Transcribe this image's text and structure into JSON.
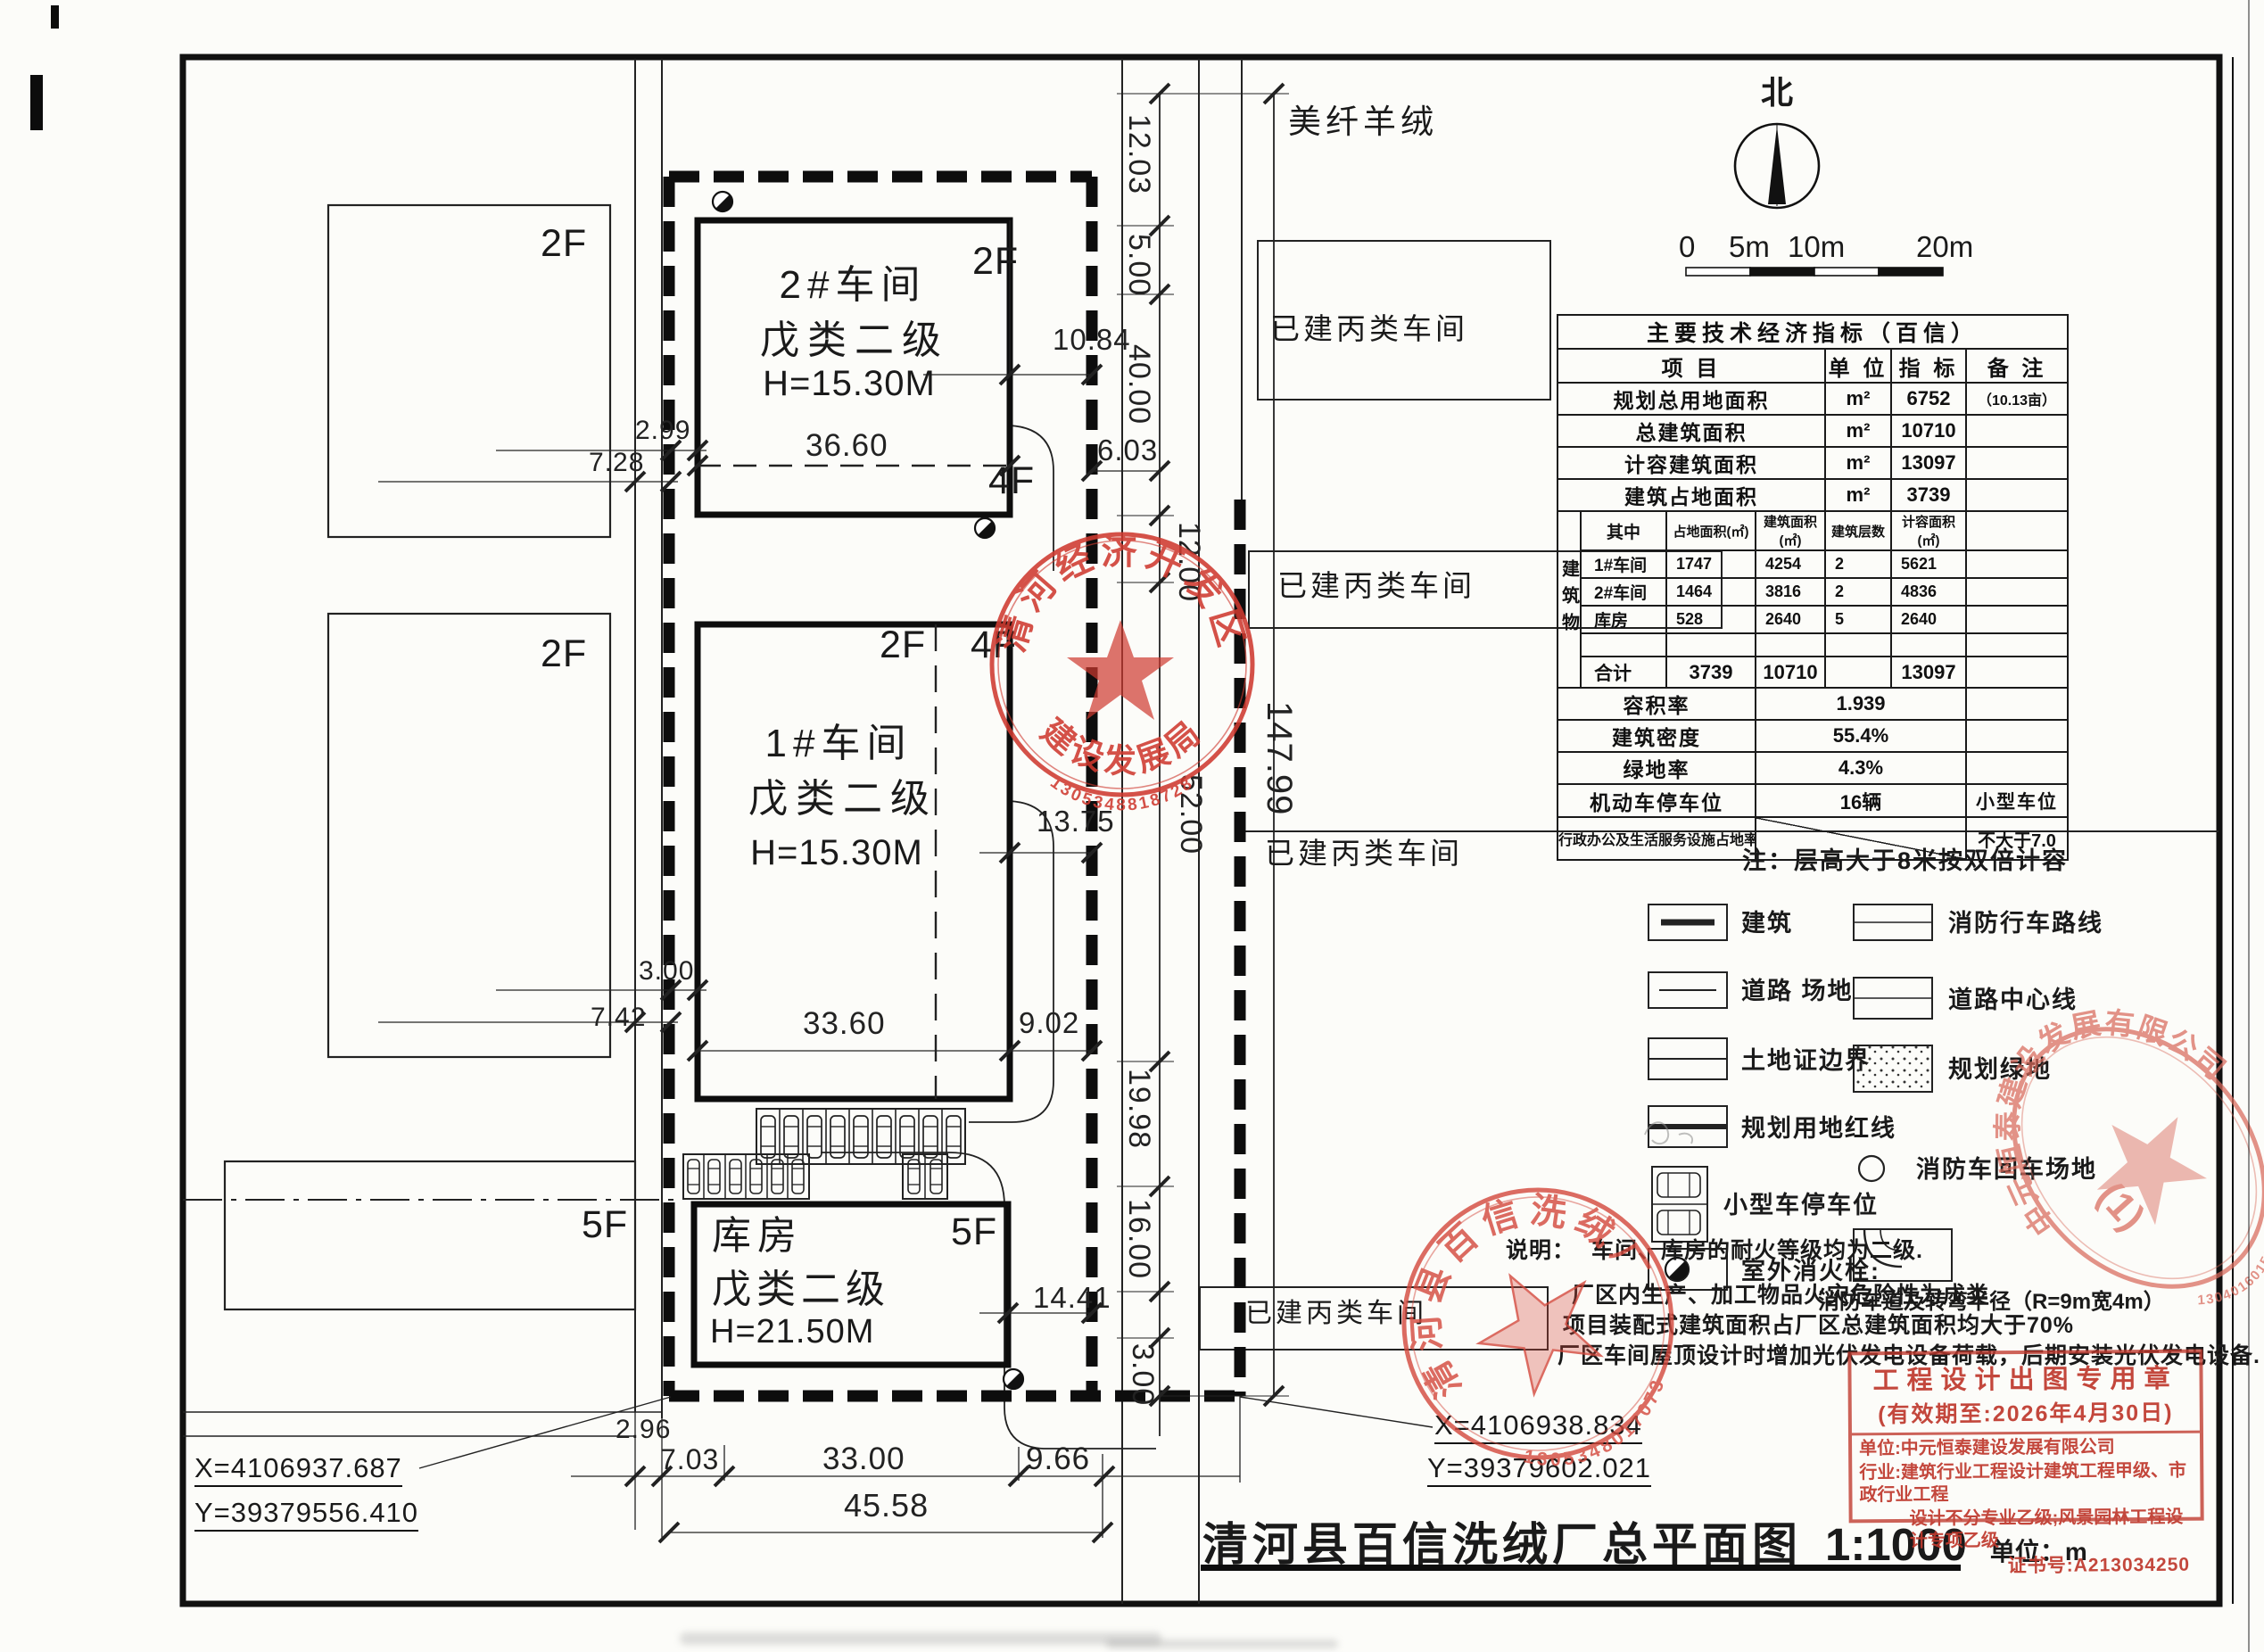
{
  "page": {
    "title": "清河县百信洗绒厂总平面图",
    "scale": "1:1000",
    "unit": "单位：m",
    "north": "北"
  },
  "scalebar": {
    "z": "0",
    "five": "5m",
    "ten": "10m",
    "twenty": "20m"
  },
  "plan": {
    "neighbor": "美纤羊绒",
    "existing": "已建丙类车间",
    "f2": "2F",
    "f4": "4F",
    "f5": "5F",
    "b2": {
      "name": "2#车间",
      "cls": "戊类二级",
      "h": "H=15.30M"
    },
    "b1": {
      "name": "1#车间",
      "cls": "戊类二级",
      "h": "H=15.30M"
    },
    "kf": {
      "name": "库房",
      "cls": "戊类二级",
      "h": "H=21.50M"
    },
    "coords": {
      "x1": "X=4106937.687",
      "y1": "Y=39379556.410",
      "x2": "X=4106938.834",
      "y2": "Y=39379602.021"
    },
    "dims": {
      "t1": "12.03",
      "t2": "5.00",
      "t3": "40.00",
      "t4": "12.00",
      "t5": "52.00",
      "t6": "19.98",
      "t7": "16.00",
      "t8": "3.00",
      "total": "147.99",
      "g1": "10.84",
      "g2": "6.03",
      "w2": "36.60",
      "o1": "2.99",
      "o2": "7.28",
      "w1": "33.60",
      "g3": "9.02",
      "g4": "13.75",
      "o3": "3.00",
      "o4": "7.42",
      "g5": "14.41",
      "b1": "2.96",
      "b2": "7.03",
      "b3": "33.00",
      "b4": "9.66",
      "b5": "45.58"
    }
  },
  "table": {
    "title": "主要技术经济指标（百信）",
    "h_item": "项 目",
    "h_unit": "单 位",
    "h_index": "指 标",
    "h_note": "备 注",
    "rows": [
      {
        "item": "规划总用地面积",
        "unit": "m²",
        "value": "6752",
        "note": "（10.13亩）"
      },
      {
        "item": "总建筑面积",
        "unit": "m²",
        "value": "10710",
        "note": ""
      },
      {
        "item": "计容建筑面积",
        "unit": "m²",
        "value": "13097",
        "note": ""
      },
      {
        "item": "建筑占地面积",
        "unit": "m²",
        "value": "3739",
        "note": ""
      }
    ],
    "group_label": "建筑物",
    "sub_headers": {
      "among": "其中",
      "footprint": "占地面积(㎡)",
      "area": "建筑面积(㎡)",
      "floors": "建筑层数",
      "capacity": "计容面积(㎡)"
    },
    "sub_rows": [
      {
        "name": "1#车间",
        "fp": "1747",
        "area": "4254",
        "floors": "2",
        "cap": "5621"
      },
      {
        "name": "2#车间",
        "fp": "1464",
        "area": "3816",
        "floors": "2",
        "cap": "4836"
      },
      {
        "name": "库房",
        "fp": "528",
        "area": "2640",
        "floors": "5",
        "cap": "2640"
      }
    ],
    "total_label": "合计",
    "total_fp": "3739",
    "total_area": "10710",
    "total_cap": "13097",
    "far_label": "容积率",
    "far": "1.939",
    "density_label": "建筑密度",
    "density": "55.4%",
    "green_label": "绿地率",
    "green": "4.3%",
    "parking_label": "机动车停车位",
    "parking": "16辆",
    "parking_note": "小型车位",
    "admin_label": "行政办公及生活服务设施占地率",
    "admin_note": "不大于7.0",
    "footnote": "注：层高大于8米按双倍计容"
  },
  "legend": {
    "left": [
      {
        "label": "建筑"
      },
      {
        "label": "道路 场地"
      },
      {
        "label": "土地证边界"
      },
      {
        "label": "规划用地红线"
      },
      {
        "label": "小型车停车位"
      },
      {
        "label": "室外消火栓:"
      }
    ],
    "right": [
      {
        "label": "消防行车路线"
      },
      {
        "label": "道路中心线"
      },
      {
        "label": "规划绿地"
      },
      {
        "label": "消防车回车场地"
      },
      {
        "label": "消防车道及转弯半径（R=9m宽4m）"
      }
    ]
  },
  "notes": {
    "label": "说明：",
    "line1": "车间、库房的耐火等级均为二级.",
    "line2": "厂区内生产、加工物品火灾危险性为戊类.",
    "line3": "项目装配式建筑面积占厂区总建筑面积均大于70%",
    "line4": "厂区车间屋顶设计时增加光伏发电设备荷载，后期安装光伏发电设备."
  },
  "stamps": {
    "dev_zone_top": "清河经济开发区",
    "dev_zone_bottom": "建设发展局",
    "dev_zone_no": "1305348818728",
    "baixin_top": "清河县百信洗绒厂",
    "baixin_no": "1305348017073",
    "company_ring": "中元恒泰建设发展有限公司",
    "company_inner": "(1)",
    "company_no": "1304016015286",
    "box_title": "工程设计出图专用章",
    "box_validity": "(有效期至:2026年4月30日)",
    "box_unit": "单位:中元恒泰建设发展有限公司",
    "box_industry1": "行业:建筑行业工程设计建筑工程甲级、市政行业工程",
    "box_industry2": "设计不分专业乙级;风景园林工程设计专项乙级",
    "box_cert": "证书号:A213034250"
  }
}
